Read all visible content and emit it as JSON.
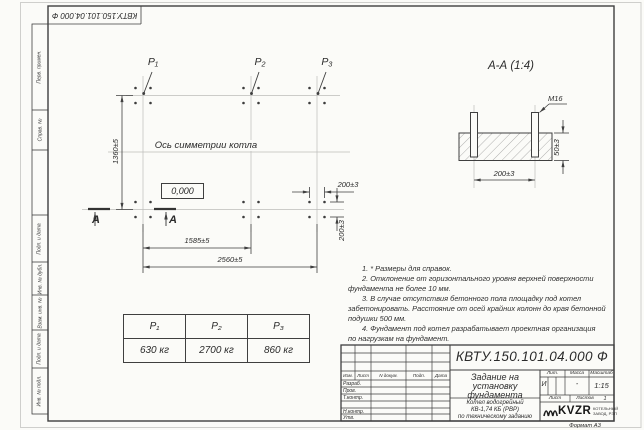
{
  "sheet": {
    "doc_number_stamp": "КВТУ.150.101.04.000 Ф",
    "format_label": "Формат А3",
    "margin_labels": [
      "Перв. примен.",
      "Справ. №",
      "Подп. и дата",
      "Инв. № дубл.",
      "Взам. инв. №",
      "Подп. и дата",
      "Инв. № подл."
    ]
  },
  "plan": {
    "point_labels": [
      "P₁",
      "P₂",
      "P₃"
    ],
    "axis_label": "Ось симметрии котла",
    "level_mark": "0,000",
    "dims": {
      "height": "1360±5",
      "width_inner": "1585±5",
      "width_total": "2560±5",
      "bolt_spacing_h": "200±3",
      "bolt_spacing_v": "200±3"
    },
    "section_mark_left": "А",
    "section_mark_right": "А"
  },
  "section": {
    "title": "А-А (1:4)",
    "thread": "М16",
    "dim_height": "50±3",
    "dim_width": "200±3"
  },
  "loads": {
    "headers": [
      "P₁",
      "P₂",
      "P₃"
    ],
    "values": [
      "630 кг",
      "2700 кг",
      "860 кг"
    ]
  },
  "notes": [
    "1. * Размеры для справок.",
    "2. Отклонение от горизонтального уровня верхней поверхности",
    "фундамента не более 10 мм.",
    "3. В случае отсутствия бетонного пола площадку под котел",
    "забетонировать. Расстояние от осей крайних колонн до края бетонной",
    "подушки 500 мм.",
    "4. Фундамент под котел разрабатывает проектная организация",
    "по нагрузкам на фундамент."
  ],
  "title_block": {
    "doc_number": "КВТУ.150.101.04.000 Ф",
    "title_lines": [
      "Задание на",
      "установку",
      "фундамента"
    ],
    "product_lines": [
      "Котел водогрейный",
      "КВ-1,74 КБ (РВР)",
      "по техническому заданию"
    ],
    "header_cols": [
      "Изм.",
      "Лист",
      "N докум.",
      "Подп.",
      "Дата"
    ],
    "signature_rows": [
      "Разраб.",
      "Пров.",
      "Т.контр.",
      "Н.контр.",
      "Утв."
    ],
    "lit_label": "Лит.",
    "lit_value": "И",
    "mass_label": "Масса",
    "mass_value": "-",
    "scale_label": "Масштаб",
    "scale_value": "1:15",
    "sheet_label": "Лист",
    "sheets_label": "Листов",
    "sheets_value": "1",
    "logo_name": "KVZR",
    "logo_sub_lines": [
      "КОТЕЛЬНЫЙ",
      "ЗАВОД, РЭП"
    ]
  }
}
